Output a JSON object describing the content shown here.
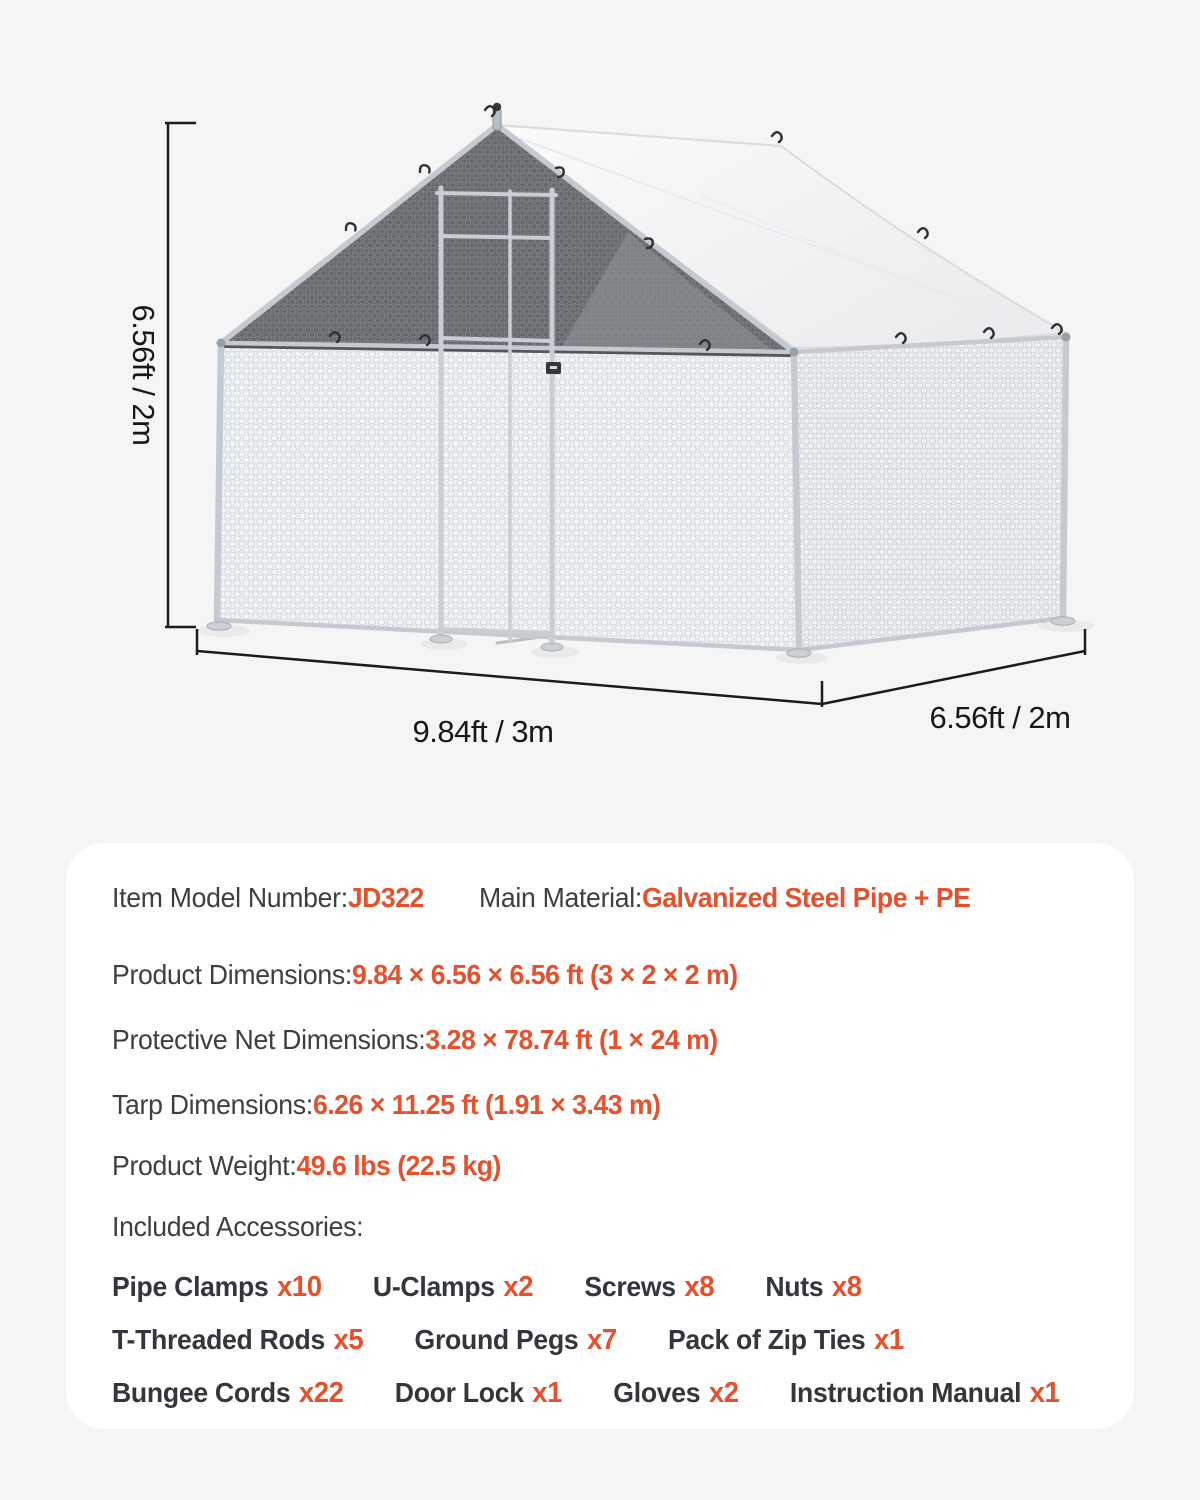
{
  "page": {
    "background": "#f5f5f6",
    "accent_color": "#e5512d",
    "card_color": "#ffffff"
  },
  "diagram": {
    "height_label": "6.56ft / 2m",
    "width_label": "9.84ft / 3m",
    "depth_label": "6.56ft / 2m",
    "tarp_color": "#f4f4f6",
    "shade_net_color": "#64676b",
    "frame_color": "#c5cad0"
  },
  "specs": {
    "rows": [
      {
        "label": "Item Model Number:",
        "value": "JD322"
      },
      {
        "label": "Main Material:",
        "value": "Galvanized Steel Pipe + PE"
      },
      {
        "label": "Product Dimensions:",
        "value": "9.84 × 6.56 × 6.56 ft (3 × 2 × 2 m)"
      },
      {
        "label": "Protective Net Dimensions: ",
        "value": "3.28 × 78.74 ft (1 × 24 m)"
      },
      {
        "label": "Tarp Dimensions:",
        "value": "6.26 × 11.25 ft (1.91 × 3.43 m)"
      },
      {
        "label": "Product Weight:",
        "value": "49.6 lbs (22.5 kg)"
      }
    ],
    "included_title": "Included Accessories:",
    "acc_rows": [
      [
        {
          "name": "Pipe Clamps",
          "qty": "x10"
        },
        {
          "name": "U-Clamps",
          "qty": "x2"
        },
        {
          "name": "Screws",
          "qty": "x8"
        },
        {
          "name": "Nuts",
          "qty": "x8"
        }
      ],
      [
        {
          "name": "T-Threaded Rods",
          "qty": "x5"
        },
        {
          "name": "Ground Pegs",
          "qty": "x7"
        },
        {
          "name": "Pack of Zip Ties",
          "qty": "x1"
        }
      ],
      [
        {
          "name": "Bungee Cords",
          "qty": "x22"
        },
        {
          "name": "Door Lock",
          "qty": "x1"
        },
        {
          "name": "Gloves",
          "qty": "x2"
        },
        {
          "name": "Instruction Manual",
          "qty": "x1"
        }
      ]
    ]
  }
}
